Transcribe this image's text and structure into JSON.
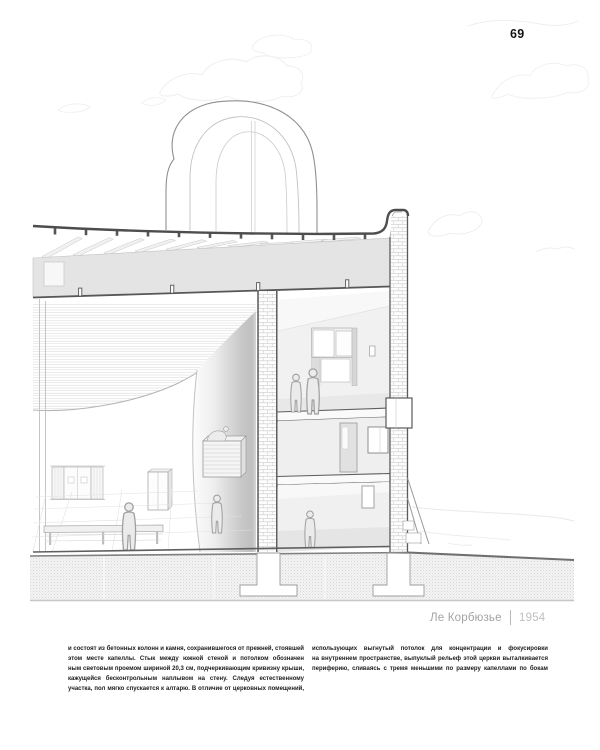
{
  "page": {
    "number": "69",
    "caption": {
      "architect": "Ле Корбюзье",
      "year": "1954"
    },
    "body_columns": {
      "left_lines": [
        "и состоят из бетонных колонн и камня, сохранившегося от прежней, стоявшей на",
        "этом месте капеллы. Стык между южной стеной и потолком обозначен стеклян-",
        "ным световым проемом шириной 20,3 см, подчеркивающим кривизну крыши,",
        "кажущейся бесконтрольным наплывом на стену. Следуя естественному рельефу",
        "участка, пол мягко спускается к алтарю. В отличие от церковных помещений,"
      ],
      "right_lines": [
        "использующих выгнутый потолок для концентрации и фокусировки внимания",
        "на внутреннем пространстве, выпуклый рельеф этой церкви выталкивается на",
        "периферию, сливаясь с тремя меньшими по размеру капеллами по бокам нефа."
      ]
    }
  },
  "drawing": {
    "colors": {
      "ink_dark": "#4d4d4d",
      "ink_mid": "#9a9a9a",
      "ink_light": "#d0d0d0",
      "band_fill": "#e4e4e4",
      "wall_gray": "#c9c9c9",
      "body_text": "#1b1b1b",
      "caption_gray": "#a2a2a2"
    }
  }
}
